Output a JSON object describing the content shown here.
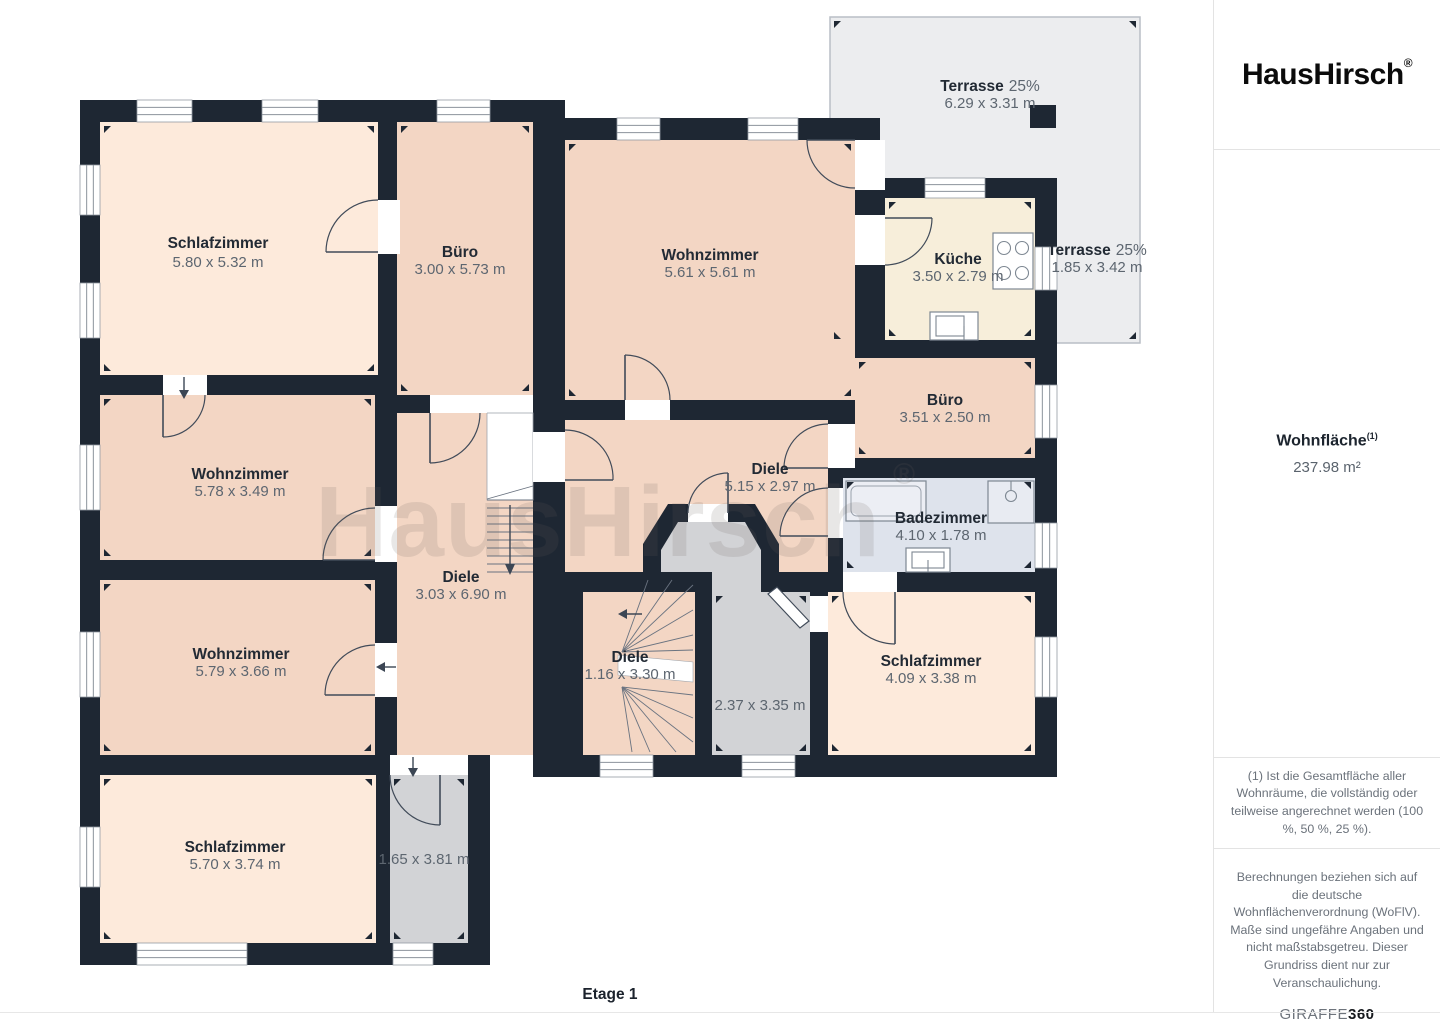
{
  "brand": {
    "name": "HausHirsch",
    "registered": "®"
  },
  "sidebar": {
    "area_label": "Wohnfläche",
    "area_sup": "(1)",
    "area_value": "237.98 m²",
    "footnote_area": "(1) Ist die Gesamtfläche aller Wohnräume, die vollständig oder teilweise angerechnet werden (100 %, 50 %, 25 %).",
    "footnote_disclaimer": "Berechnungen beziehen sich auf die deutsche Wohnflächenverordnung (WoFlV). Maße sind ungefähre Angaben und nicht maßstabsgetreu. Dieser Grundriss dient nur zur Veranschaulichung.",
    "brand_giraffe": "GIRAFFE",
    "brand_giraffe_360": "360"
  },
  "floor_label": "Etage 1",
  "watermark": {
    "text": "HausHirsch",
    "registered": "®"
  },
  "colors": {
    "wall": "#1e2733",
    "room_warm": "#f3d6c4",
    "room_cream": "#fdeadb",
    "kitchen": "#f7eeda",
    "bath": "#dee3ec",
    "gray": "#d2d3d6",
    "terrace": "#ecedef",
    "terrace_border": "#b9bec5",
    "label": "#222a34",
    "dims": "#5d6670"
  },
  "rooms": [
    {
      "name": "Schlafzimmer",
      "dims": "5.80 x 5.32 m"
    },
    {
      "name": "Büro",
      "dims": "3.00 x 5.73 m"
    },
    {
      "name": "Wohnzimmer",
      "dims": "5.61 x 5.61 m"
    },
    {
      "name": "Küche",
      "dims": "3.50 x 2.79 m"
    },
    {
      "name": "Terrasse",
      "pct": "25%",
      "dims": "6.29 x 3.31 m"
    },
    {
      "name": "Terrasse",
      "pct": "25%",
      "dims": "1.85 x 3.42 m"
    },
    {
      "name": "Büro",
      "dims": "3.51 x 2.50 m"
    },
    {
      "name": "Wohnzimmer",
      "dims": "5.78 x 3.49 m"
    },
    {
      "name": "Diele",
      "dims": "5.15 x 2.97 m"
    },
    {
      "name": "Badezimmer",
      "dims": "4.10 x 1.78 m"
    },
    {
      "name": "Diele",
      "dims": "3.03 x 6.90 m"
    },
    {
      "name": "Wohnzimmer",
      "dims": "5.79 x 3.66 m"
    },
    {
      "name": "Diele",
      "dims": "1.16 x 3.30 m"
    },
    {
      "dims": "2.37 x 3.35 m"
    },
    {
      "name": "Schlafzimmer",
      "dims": "4.09 x 3.38 m"
    },
    {
      "name": "Schlafzimmer",
      "dims": "5.70 x 3.74 m"
    },
    {
      "dims": "1.65 x 3.81 m"
    }
  ]
}
